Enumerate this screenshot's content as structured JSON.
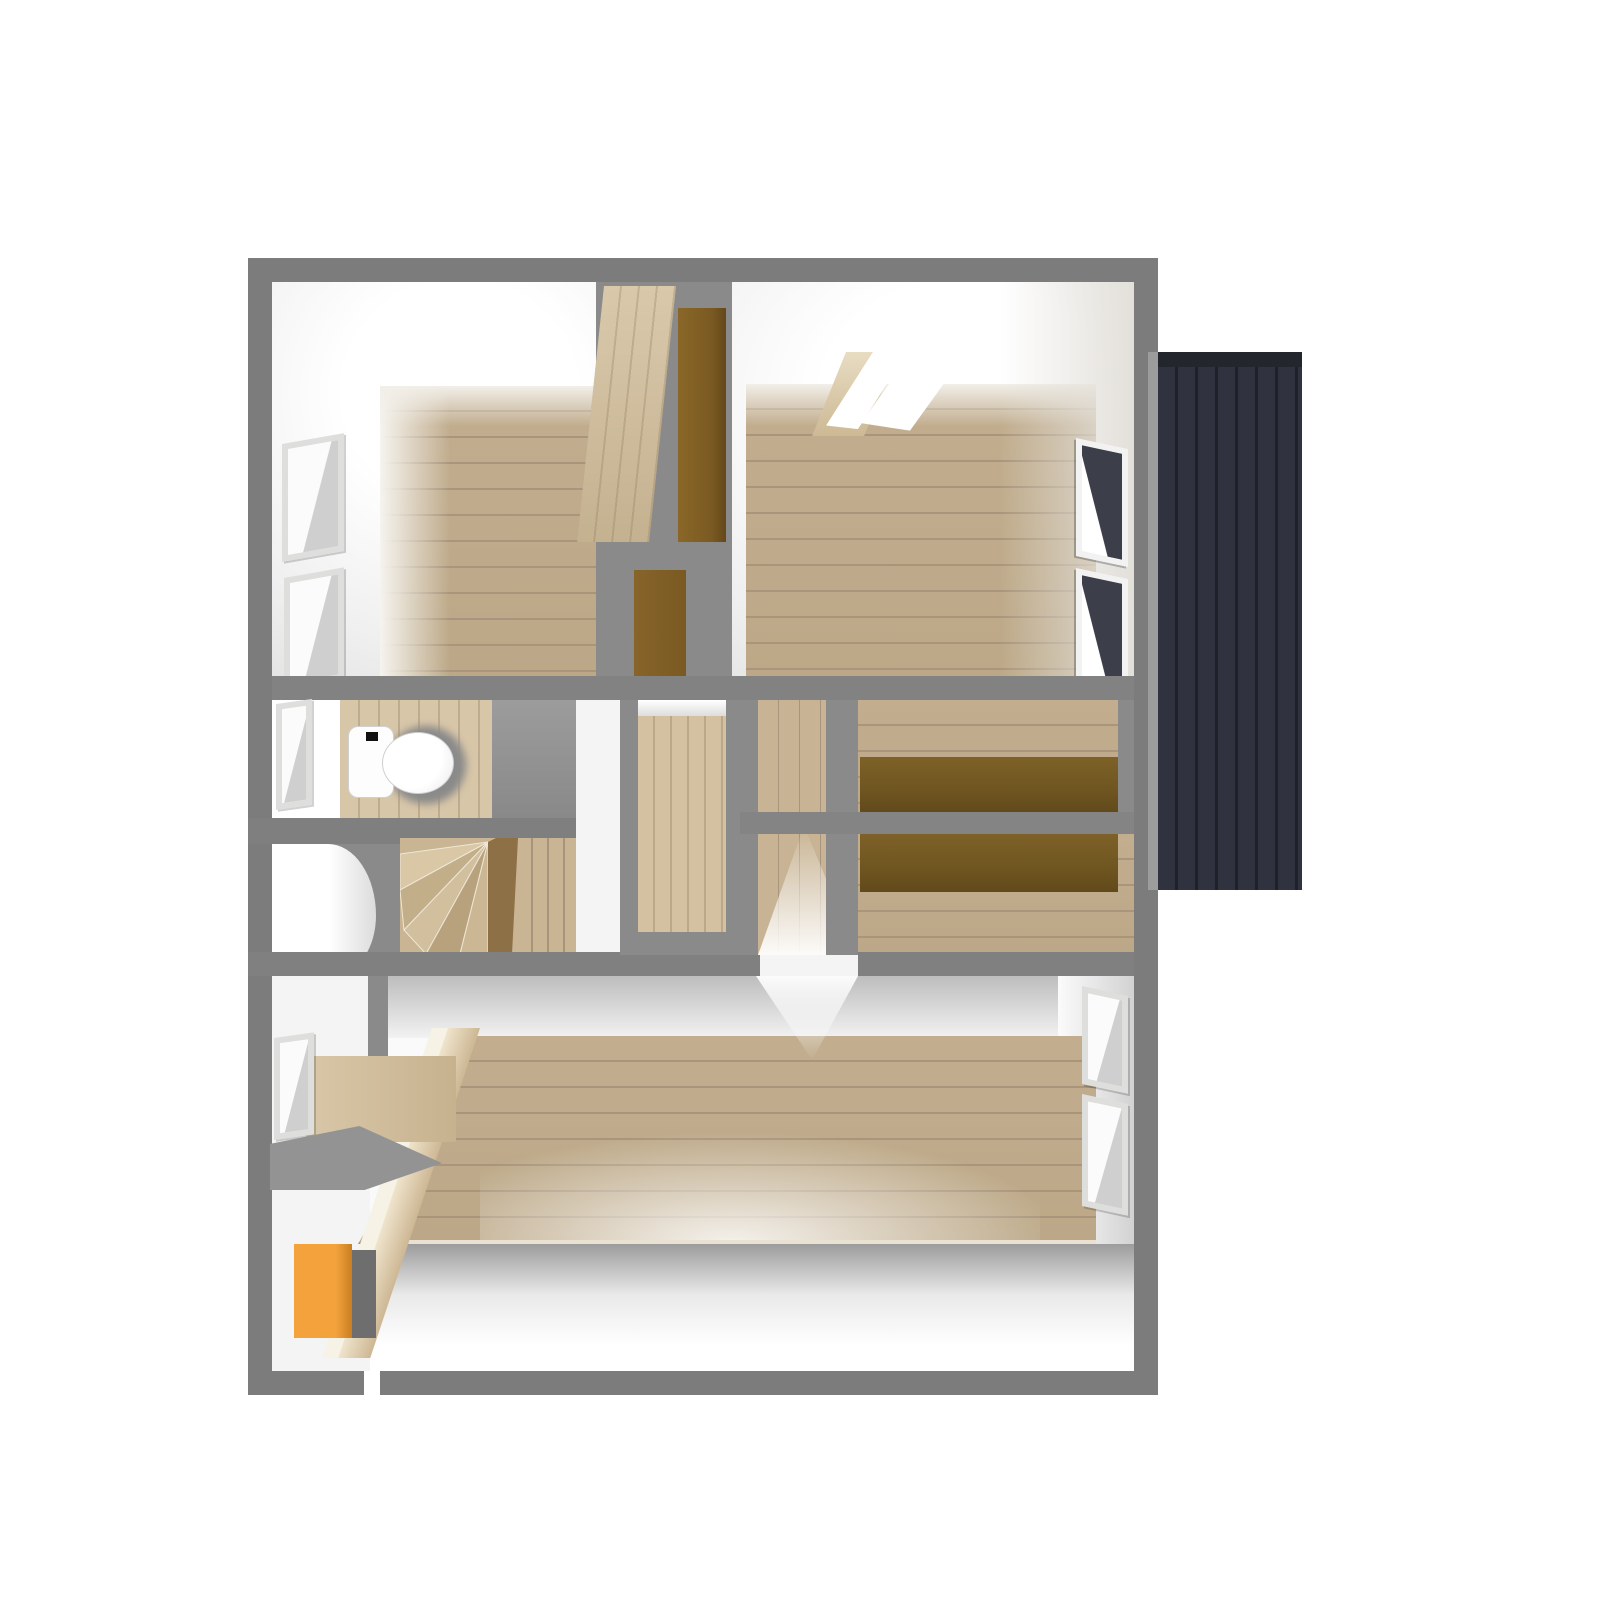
{
  "scene": {
    "kind": "3d-floorplan-top-down-render",
    "floor": "upper floor with stairwell",
    "fixtures": [
      "toilet",
      "winder-stairs",
      "central-wardrobe",
      "built-in-desk-upper",
      "built-in-desk-lower",
      "side-deck-exterior",
      "orange-cabinet",
      "window-seat-counter"
    ],
    "window_count": 9,
    "rooms": [
      "bedroom-top-left",
      "bedroom-top-right",
      "toilet-room",
      "hallway",
      "desk-room-a",
      "desk-room-b",
      "main-room-bottom"
    ]
  },
  "colors": {
    "page_bg": "#ffffff",
    "outer_wall": "#7c7c7c",
    "inner_wall": "#8a8a8a",
    "wall_highlight": "#9c9c9c",
    "floor_wood": "#c2ae8f",
    "floor_wood_seam": "#a9957b",
    "corridor_wood": "#c8b494",
    "panel_wood": "#cfbc9d",
    "desk_brown": "#6f5520",
    "door_brown": "#7a5a22",
    "deck_base": "#30333f",
    "deck_seam": "#1f2129",
    "deck_header": "#24262e",
    "cabinet_orange": "#f3a23c",
    "cabinet_orange_shade": "#c97f22",
    "glass_light": "#f5f5f5",
    "glass_dark": "#3c3f4a",
    "frame_gray": "#b5b5b5",
    "toilet_white": "#fdfdfd",
    "baseboard": "#e9e2d2"
  }
}
